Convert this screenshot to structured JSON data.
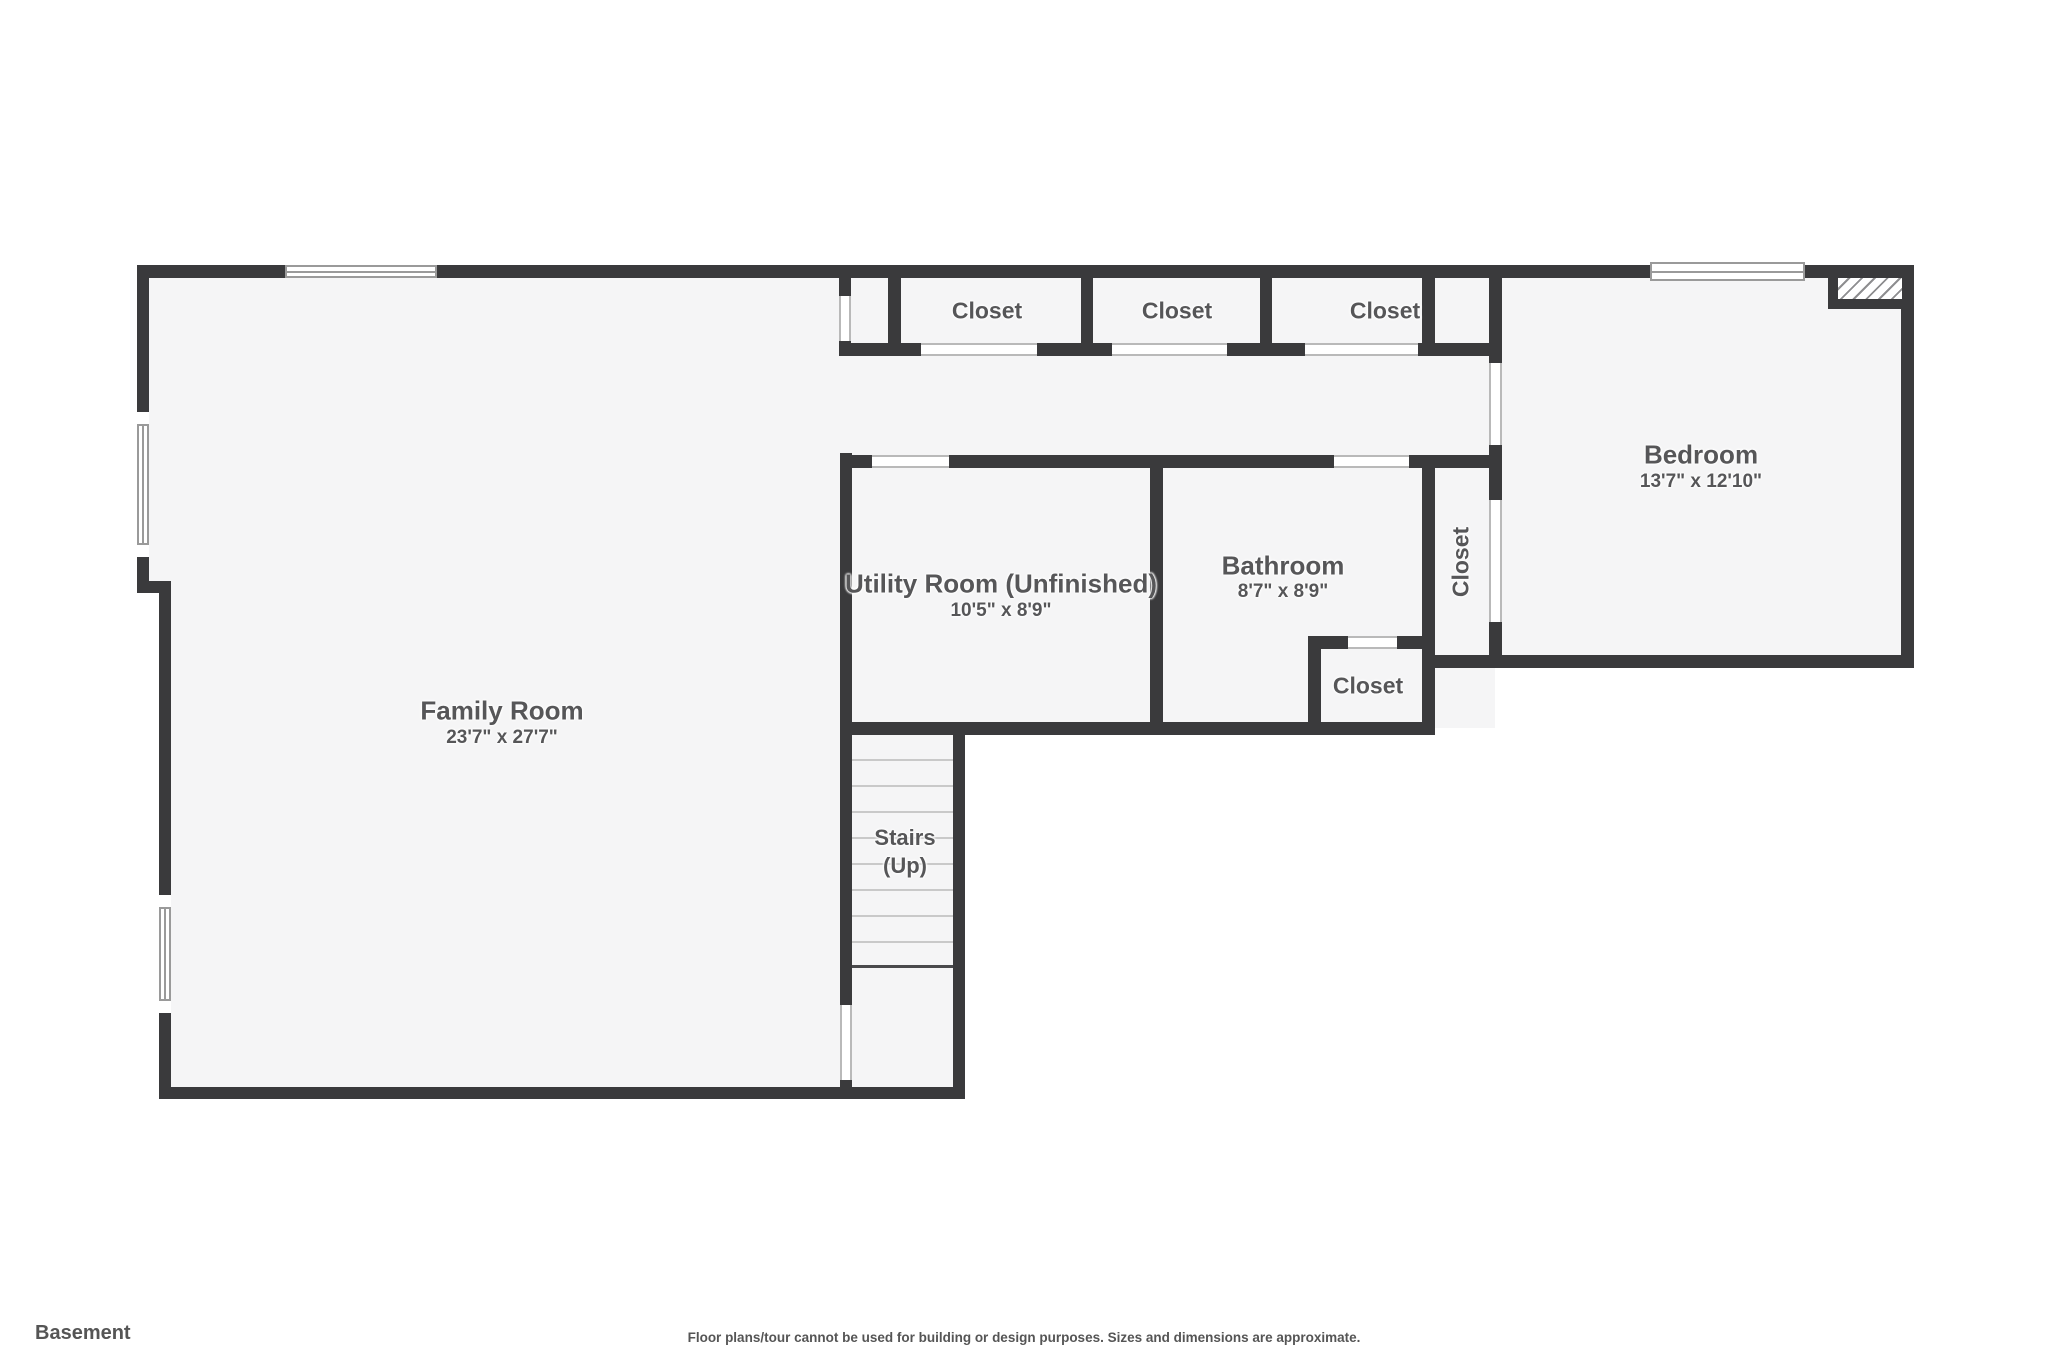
{
  "plan": {
    "floor_label": "Basement",
    "disclaimer": "Floor plans/tour cannot be used for building or design purposes. Sizes and dimensions are approximate.",
    "rooms": {
      "family_room": {
        "name": "Family Room",
        "dims": "23'7\" x 27'7\""
      },
      "utility_room": {
        "name": "Utility Room (Unfinished)",
        "dims": "10'5\" x 8'9\""
      },
      "bathroom": {
        "name": "Bathroom",
        "dims": "8'7\" x 8'9\""
      },
      "bedroom": {
        "name": "Bedroom",
        "dims": "13'7\" x 12'10\""
      },
      "stairs": {
        "name": "Stairs",
        "direction": "(Up)"
      },
      "closet_top_1": {
        "name": "Closet"
      },
      "closet_top_2": {
        "name": "Closet"
      },
      "closet_top_3": {
        "name": "Closet"
      },
      "closet_vertical": {
        "name": "Closet"
      },
      "closet_small": {
        "name": "Closet"
      }
    },
    "colors": {
      "wall": "#3a3a3c",
      "floor": "#f5f5f6",
      "outside": "#ffffff",
      "text": "#565658",
      "tread": "#c9c9c9",
      "winline": "#9a9a9a"
    }
  }
}
